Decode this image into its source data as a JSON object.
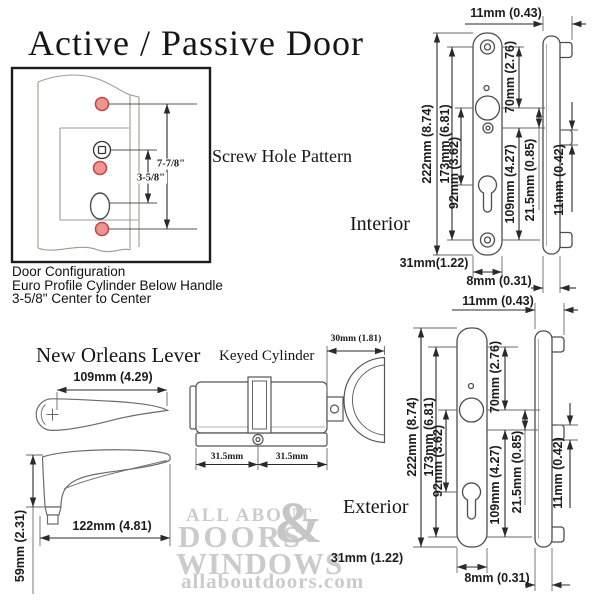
{
  "title": "Active / Passive Door",
  "config": {
    "screw_hole_pattern_label": "Screw Hole Pattern",
    "dim_top_span": "7-7/8\"",
    "dim_center_span": "3-5/8\"",
    "caption_line1": "Door Configuration",
    "caption_line2": "Euro Profile Cylinder Below Handle",
    "caption_line3": "3-5/8\" Center to Center"
  },
  "interior": {
    "label": "Interior",
    "dims": {
      "side_depth": "11mm (0.43)",
      "overall_height": "222mm (8.74)",
      "screw_spacing": "173mm (6.81)",
      "top_to_spindle": "70mm (2.76)",
      "spindle_to_cylinder": "92mm (3.62)",
      "lower_span": "109mm (4.27)",
      "spindle_to_screw": "21.5mm (0.85)",
      "tab_height": "11mm (0.42)",
      "plate_width": "31mm(1.22)",
      "plate_thickness": "8mm (0.31)"
    }
  },
  "exterior": {
    "label": "Exterior",
    "dims": {
      "side_depth": "11mm (0.43)",
      "overall_height": "222mm (8.74)",
      "screw_spacing": "173mm (6.81)",
      "top_to_spindle": "70mm (2.76)",
      "spindle_to_cylinder": "92mm (3.62)",
      "lower_span": "109mm (4.27)",
      "spindle_to_screw": "21.5mm (0.85)",
      "tab_height": "11mm (0.42)",
      "plate_width": "31mm (1.22)",
      "plate_thickness": "8mm (0.31)"
    }
  },
  "lever": {
    "label": "New Orleans Lever",
    "top_length": "109mm (4.29)",
    "side_length": "122mm (4.81)",
    "height": "59mm (2.31)"
  },
  "cylinder": {
    "label": "Keyed Cylinder",
    "thumbturn_depth": "30mm (1.81)",
    "left_half": "31.5mm",
    "right_half": "31.5mm"
  },
  "watermark": {
    "line1": "ALL ABOUT",
    "line2": "DOORS",
    "ampersand": "&",
    "line3": "WINDOWS",
    "line4": "allaboutdoors.com"
  },
  "colors": {
    "screw_hole_red_fill": "#ee9592",
    "screw_hole_red_stroke": "#bf4a47",
    "dimension_line": "#2a2a2a",
    "watermark_gray": "#cbcbcb"
  }
}
